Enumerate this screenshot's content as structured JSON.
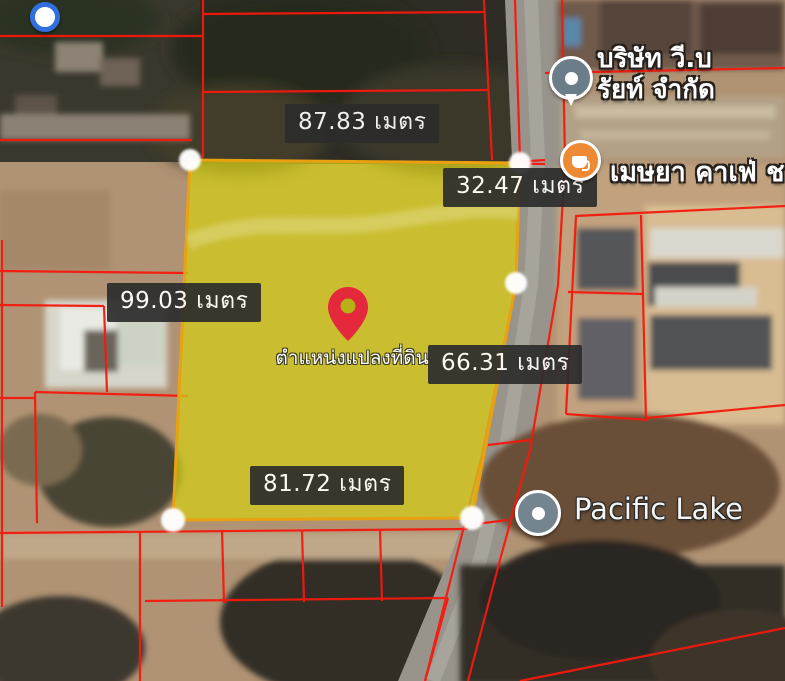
{
  "map": {
    "type": "satellite-cadastral-view",
    "parcel": {
      "pin_label": "ตำแหน่งแปลงที่ดิน",
      "measurements": {
        "top": "87.83 เมตร",
        "right_upper": "32.47 เมตร",
        "left": "99.03 เมตร",
        "right_lower": "66.31 เมตร",
        "bottom": "81.72 เมตร"
      }
    },
    "pois": {
      "company": {
        "name_line1": "บริษัท วี.บ",
        "name_line2": "รัยท์ จำกัด",
        "icon": "place-poi-icon"
      },
      "cafe": {
        "name": "เมษยา คาเฟ่ ช",
        "icon": "cafe-icon"
      },
      "lake": {
        "name": "Pacific Lake",
        "icon": "lake-poi-icon"
      },
      "marker_top_left": {
        "icon": "blue-dot-marker-icon"
      }
    }
  },
  "theme": {
    "cadastral_red": "#f6180c",
    "parcel_fill": "#d3cc17",
    "parcel_border": "#e9a011",
    "label_bg": "#2c2c2c",
    "pin_red": "#e5293d",
    "cafe_orange": "#ee8a33",
    "poi_slate": "#74858f",
    "marker_blue": "#2f6fdf"
  }
}
